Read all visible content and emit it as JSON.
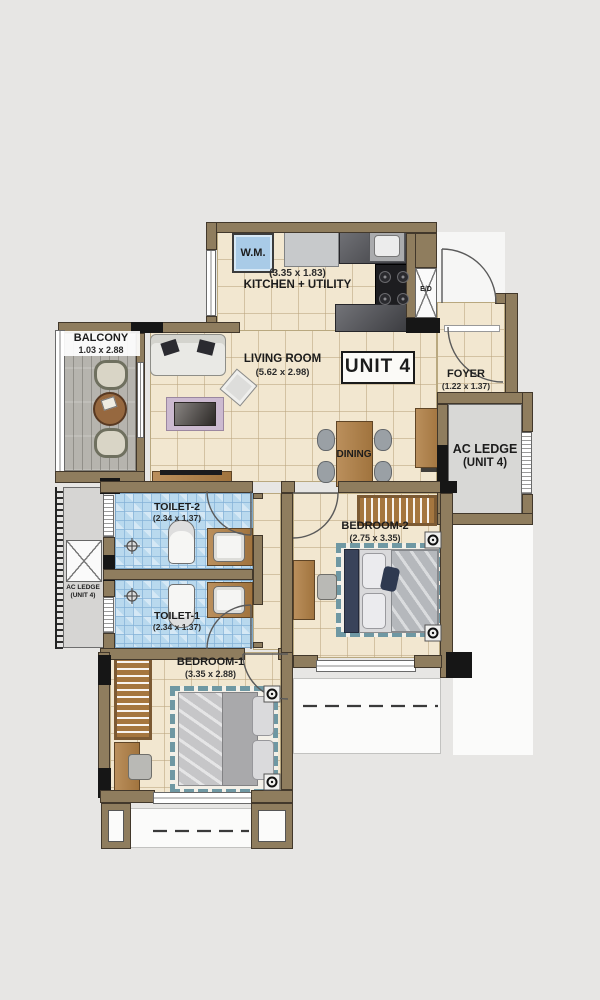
{
  "title": "Unit 4 Floor Plan",
  "unit": {
    "label": "UNIT 4"
  },
  "rooms": {
    "kitchen": {
      "name": "KITCHEN + UTILITY",
      "dims": "(3.35 x 1.83)"
    },
    "living": {
      "name": "LIVING ROOM",
      "dims": "(5.62 x 2.98)"
    },
    "dining": {
      "name": "DINING"
    },
    "foyer": {
      "name": "FOYER",
      "dims": "(1.22 x 1.37)"
    },
    "balcony": {
      "name": "BALCONY",
      "dims": "1.03 x 2.88"
    },
    "toilet2": {
      "name": "TOILET-2",
      "dims": "(2.34 x 1.37)"
    },
    "toilet1": {
      "name": "TOILET-1",
      "dims": "(2.34 x 1.37)"
    },
    "bedroom2": {
      "name": "BEDROOM-2",
      "dims": "(2.75 x 3.35)"
    },
    "bedroom1": {
      "name": "BEDROOM-1",
      "dims": "(3.35 x 2.88)"
    },
    "ac_ledge_right": {
      "name": "AC LEDGE",
      "sub": "(UNIT 4)"
    },
    "ac_ledge_left": {
      "name": "AC LEDGE",
      "sub": "(UNIT 4)"
    }
  },
  "fixtures": {
    "washing_machine": "W.M.",
    "electrical_duct": "E/D"
  },
  "colors": {
    "background": "#e7e6e4",
    "wall": "#8f7d5e",
    "floor_tile": "#f2e7d0",
    "toilet_tile": "#b9d9ee",
    "balcony_deck": "#b6b4ae",
    "ac_ledge": "#d6d5d3",
    "wood": "#a5763f",
    "wm_fill": "#a9cbe7",
    "counter_granite": "#55565c"
  }
}
